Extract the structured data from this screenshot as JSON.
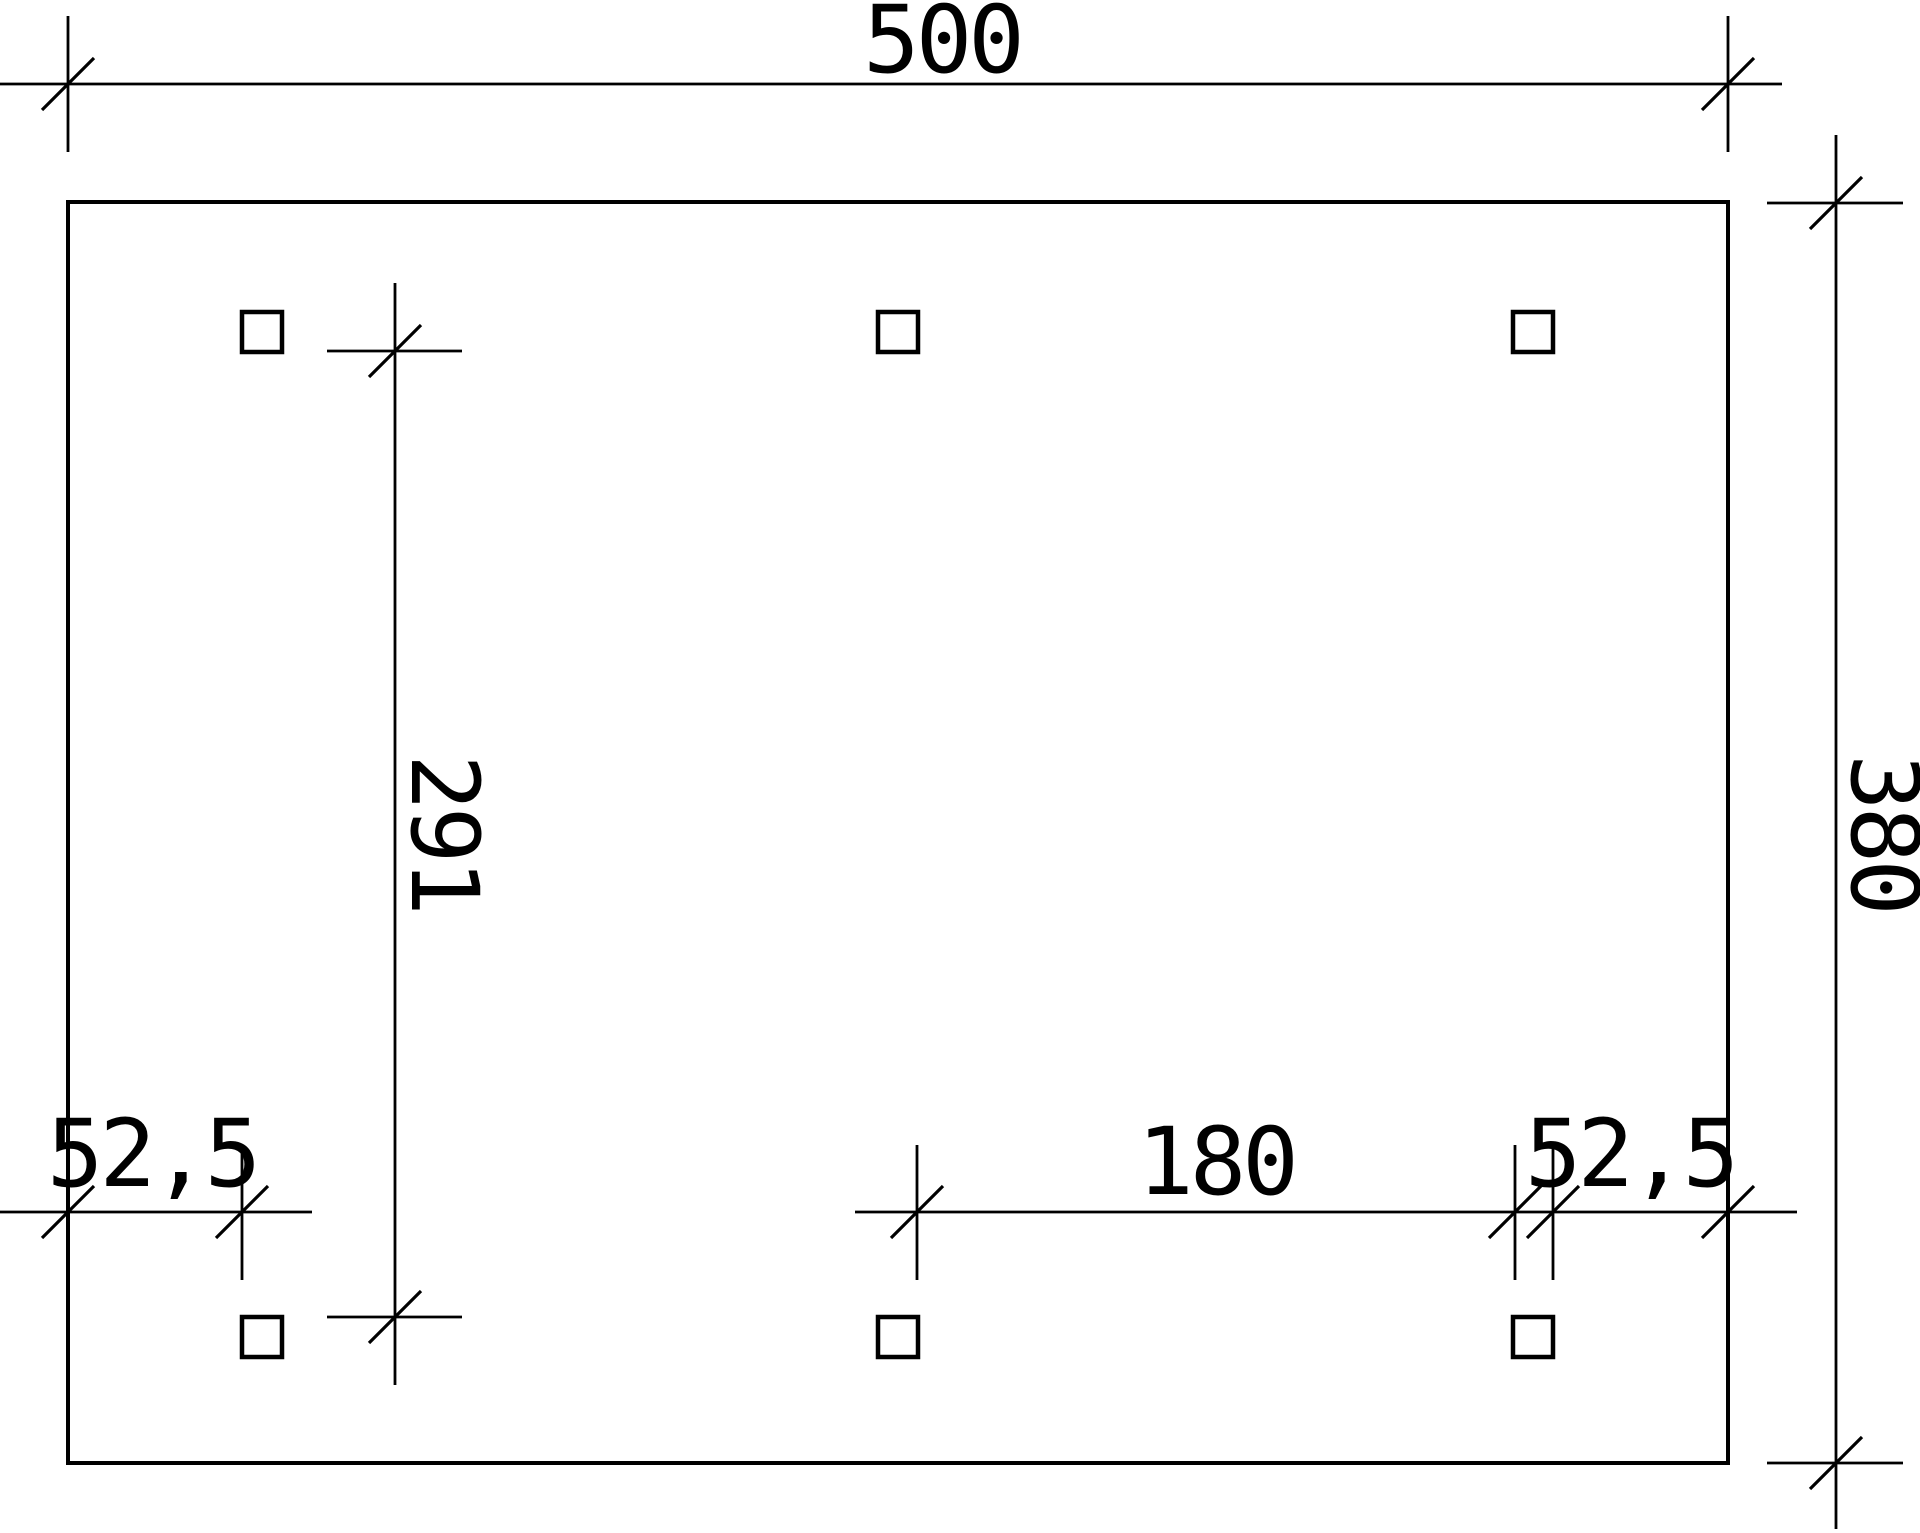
{
  "drawing": {
    "description": "Dimensioned ground plan (plan view) with rectangular outline and six square posts",
    "units": "cm",
    "background_color": "#ffffff",
    "line_color": "#000000",
    "dimensions": {
      "overall_width": {
        "label": "500",
        "value": 500
      },
      "overall_depth": {
        "label": "380",
        "value": 380
      },
      "post_clear_span": {
        "label": "291",
        "value": 291
      },
      "left_edge_offset": {
        "label": "52,5",
        "value": 52.5
      },
      "post_spacing": {
        "label": "180",
        "value": 180
      },
      "right_edge_offset": {
        "label": "52,5",
        "value": 52.5
      }
    },
    "posts": {
      "count": 6,
      "rows": 2,
      "columns": 3,
      "shape": "square"
    }
  }
}
